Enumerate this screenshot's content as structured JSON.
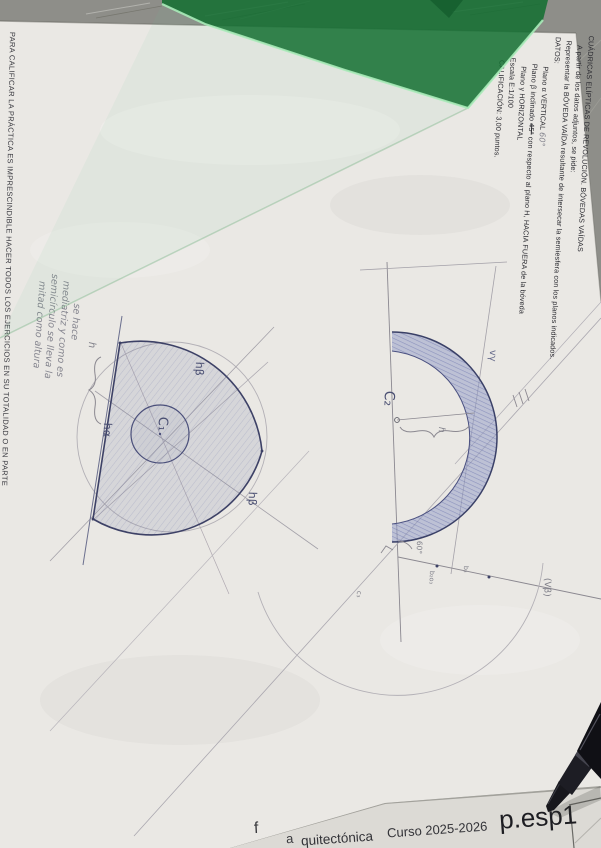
{
  "photo": {
    "desk_color": "#8e8e89",
    "paper_color": "#eae8e4",
    "under_sheet_color": "#dcdad5",
    "ruler_color": "#127030",
    "pen_color": "#121217",
    "pencil_color": "#8b8890",
    "ink_color": "#3d4166",
    "vault_blue": "#98a0c8"
  },
  "side_note": "PARA CALIFICAR LA PRÁCTICA ES IMPRESCINDIBLE HACER TODOS LOS EJERCICIOS EN SU TOTALIDAD O EN PARTE",
  "title_block": {
    "title": "CUÁDRICAS ELÍPTICAS DE REVOLUCIÓN. BÓVEDAS VAÍDAS",
    "intro": "A partir de los datos adjuntos, se pide:",
    "task": "Representar la BÓVEDA VAÍDA resultante de intersecar la semiesfera con los planos indicados.",
    "datos_heading": "DATOS:",
    "plano_alpha": "Plano α VERTICAL",
    "plano_alpha_note": "60°",
    "plano_beta_pre": "Plano β inclinado ",
    "plano_beta_struck": "45°",
    "plano_beta_post": " con respecto al plano H, HACIA FUERA de la bóveda",
    "plano_gamma": "Plano γ HORIZONTAL",
    "escala": "Escala E:1/100",
    "calificacion": "CALIFICACIÓN: 3,00 puntos."
  },
  "handwritten_note": {
    "l1": "se hace",
    "l2": "mediatriz y como es",
    "l3": "semicírculo se lleva la",
    "l4": "mitad como altura"
  },
  "plan_labels": {
    "c1": "C₁",
    "h_alpha": "hα",
    "h_beta_top": "hβ",
    "h_beta_bottom": "hβ",
    "height": "h"
  },
  "elevation_labels": {
    "c2": "C₂",
    "height": "h",
    "v_gamma": "vγ",
    "angle": "60°",
    "v_beta": "(Vβ)",
    "pt_a": "b₂o₃",
    "pt_b": "b₃",
    "pt_c": "c₃"
  },
  "footer": {
    "frag1": "f",
    "frag2": "a",
    "frag3": "quitectónica",
    "course": "Curso 2025-2026",
    "code": "p.esp1"
  }
}
